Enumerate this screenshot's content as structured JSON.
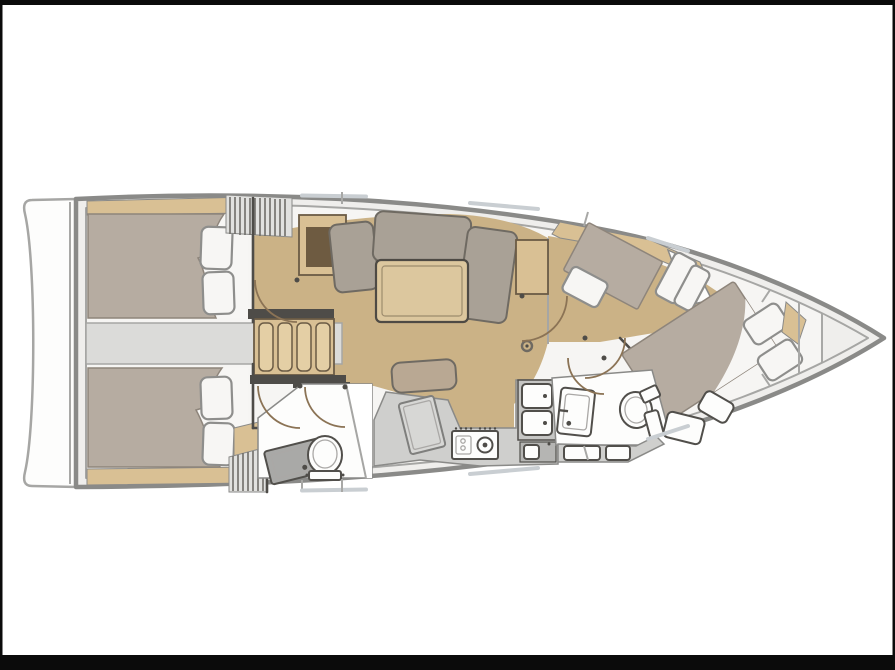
{
  "image": {
    "description": "Top-view interior layout floor plan of a sailing yacht, bow to the right: two aft double cabins with a companionway between them, saloon with U-shaped settee and table, chart table, galley with stove and twin sinks, aft head with toilet and shower, forward head, mid cabin berth and forward V-berth, swim platform at the stern"
  },
  "colors": {
    "frame_black": "#0b0b0b",
    "platform": "#fdfdfc",
    "deck": "#efeeec",
    "interior": "#f6f5f3",
    "hull_line": "#8a8a88",
    "inner_line": "#a6a6a4",
    "floor_wood": "#cbb286",
    "furniture_wood": "#d9c094",
    "slat_wood": "#e4cfa5",
    "wood_edge": "#6b5b45",
    "dark_inset": "#6e5b41",
    "table_wood": "#dcc79e",
    "table_edge": "#4e4a44",
    "blanket": "#b6aca1",
    "blanket_edge": "#8e857b",
    "linen": "#f7f6f4",
    "linen_edge": "#8e8e8c",
    "cushion": "#a9a196",
    "cushion_edge": "#6f6a62",
    "seat_wood": "#b9a893",
    "corridor": "#dbdbd9",
    "counter": "#cfcfcd",
    "counter_dark": "#c6c6c4",
    "cabinet_dark": "#b5b5b3",
    "fixture_white": "#fdfdfc",
    "fixture_edge": "#514f4b",
    "fixture_inner": "#aaa8a6",
    "sink_gray": "#a9a9a7",
    "desk_gray": "#d7d7d5",
    "desk_edge": "#7f7f7d",
    "wall_dark": "#4e4c48",
    "arc": "#8b7355",
    "louver_line": "#6f6d69",
    "louver_bg": "#e1e1df",
    "window": "#c9ced2",
    "seam": "#a8a8a6"
  }
}
